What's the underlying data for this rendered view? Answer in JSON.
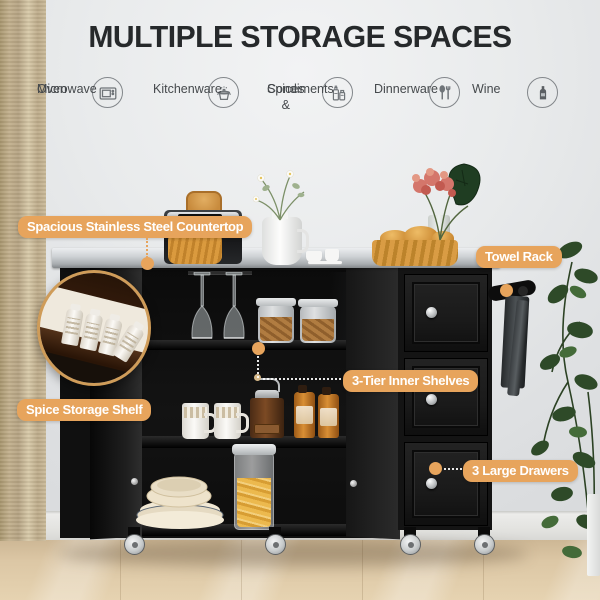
{
  "title": "MULTIPLE STORAGE SPACES",
  "features": [
    {
      "icon": "microwave-icon",
      "line1": "Microwave",
      "line2": "Oven"
    },
    {
      "icon": "kitchenware-icon",
      "line1": "Kitchenware",
      "line2": ""
    },
    {
      "icon": "spices-icon",
      "line1": "Spices &",
      "line2": "Condiments"
    },
    {
      "icon": "dinnerware-icon",
      "line1": "Dinnerware",
      "line2": ""
    },
    {
      "icon": "wine-icon",
      "line1": "Wine",
      "line2": ""
    }
  ],
  "callouts": {
    "countertop": "Spacious Stainless Steel Countertop",
    "towel_rack": "Towel Rack",
    "shelves": "3-Tier Inner Shelves",
    "spice_shelf": "Spice Storage Shelf",
    "drawers": "3 Large Drawers"
  },
  "colors": {
    "badge": "#E7A45C",
    "title_text": "#26292B",
    "icon_stroke": "#6F7478",
    "cart_black": "#141414",
    "countertop_steel": "#C9CDD0",
    "floor": "#DCC7A5",
    "curtain": "#C2B08D"
  }
}
